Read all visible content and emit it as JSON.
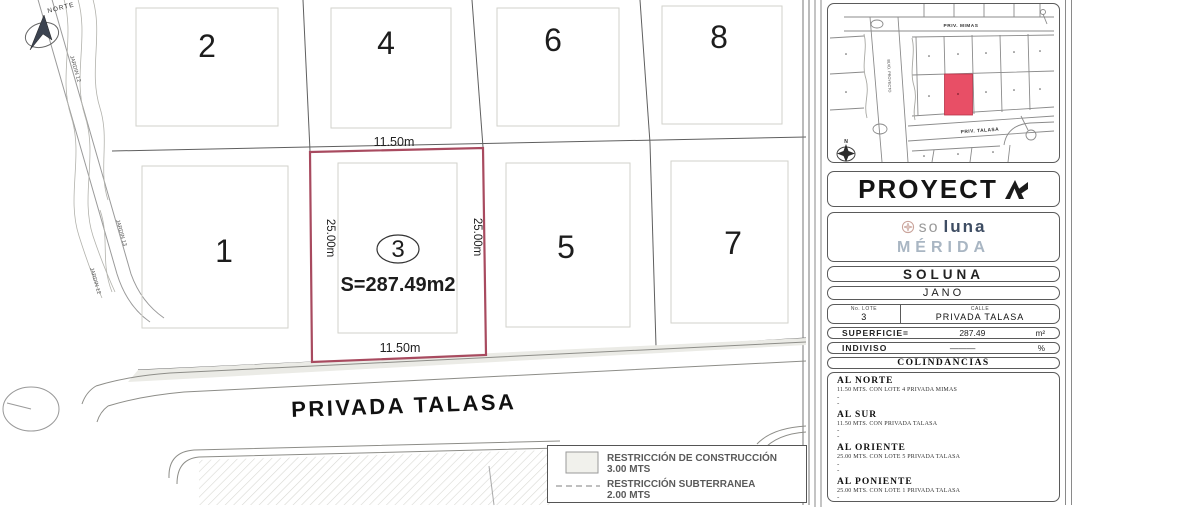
{
  "colors": {
    "highlight_border": "#a84a5f",
    "minimap_highlight": "#e84f66",
    "merida_text": "#a9b6c3",
    "luna_text": "#3e4d63",
    "rosette": "#c8a198"
  },
  "plan": {
    "north_label": "NORTE",
    "road_labels": [
      "JARDIN 12",
      "JARDIN 13",
      "JARDIN 12"
    ],
    "street_label": "PRIVADA TALASA",
    "lots_top": [
      "2",
      "4",
      "6",
      "8"
    ],
    "lots_bottom": [
      "1",
      "5",
      "7"
    ],
    "lot3": {
      "number": "3",
      "dim_top": "11.50m",
      "dim_bottom": "11.50m",
      "dim_left": "25.00m",
      "dim_right": "25.00m",
      "area": "S=287.49m2"
    },
    "legend": {
      "construction_label": "RESTRICCIÓN DE CONSTRUCCIÓN",
      "construction_value": "3.00 MTS",
      "underground_label": "RESTRICCIÓN  SUBTERRANEA",
      "underground_value": "2.00 MTS"
    }
  },
  "sidebar": {
    "minimap": {
      "street_top": "PRIV. MIMAS",
      "street_mid": "PRIV. TALASA",
      "blvd_label": "BLVD. PROYECTO",
      "north_label": "N"
    },
    "proyecta_text": "PROYECT",
    "soluna_logo": {
      "prefix": "so",
      "suffix": "luna",
      "city": "MÉRIDA"
    },
    "development": "SOLUNA",
    "privada": "JANO",
    "lot": {
      "label": "No. LOTE",
      "value": "3"
    },
    "calle": {
      "label": "CALLE",
      "value": "PRIVADA TALASA"
    },
    "superficie": {
      "label": "SUPERFICIE=",
      "value": "287.49",
      "unit": "m²"
    },
    "indiviso": {
      "label": "INDIVISO",
      "value": "———",
      "unit": "%"
    },
    "colindancias": {
      "title": "COLINDANCIAS",
      "dash": "-",
      "items": [
        {
          "heading": "AL NORTE",
          "detail": "11.50 MTS. CON LOTE 4 PRIVADA MIMAS"
        },
        {
          "heading": "AL SUR",
          "detail": "11.50 MTS. CON PRIVADA TALASA"
        },
        {
          "heading": "AL ORIENTE",
          "detail": "25.00 MTS. CON LOTE 5 PRIVADA TALASA"
        },
        {
          "heading": "AL PONIENTE",
          "detail": "25.00 MTS. CON LOTE 1 PRIVADA TALASA"
        }
      ]
    }
  }
}
